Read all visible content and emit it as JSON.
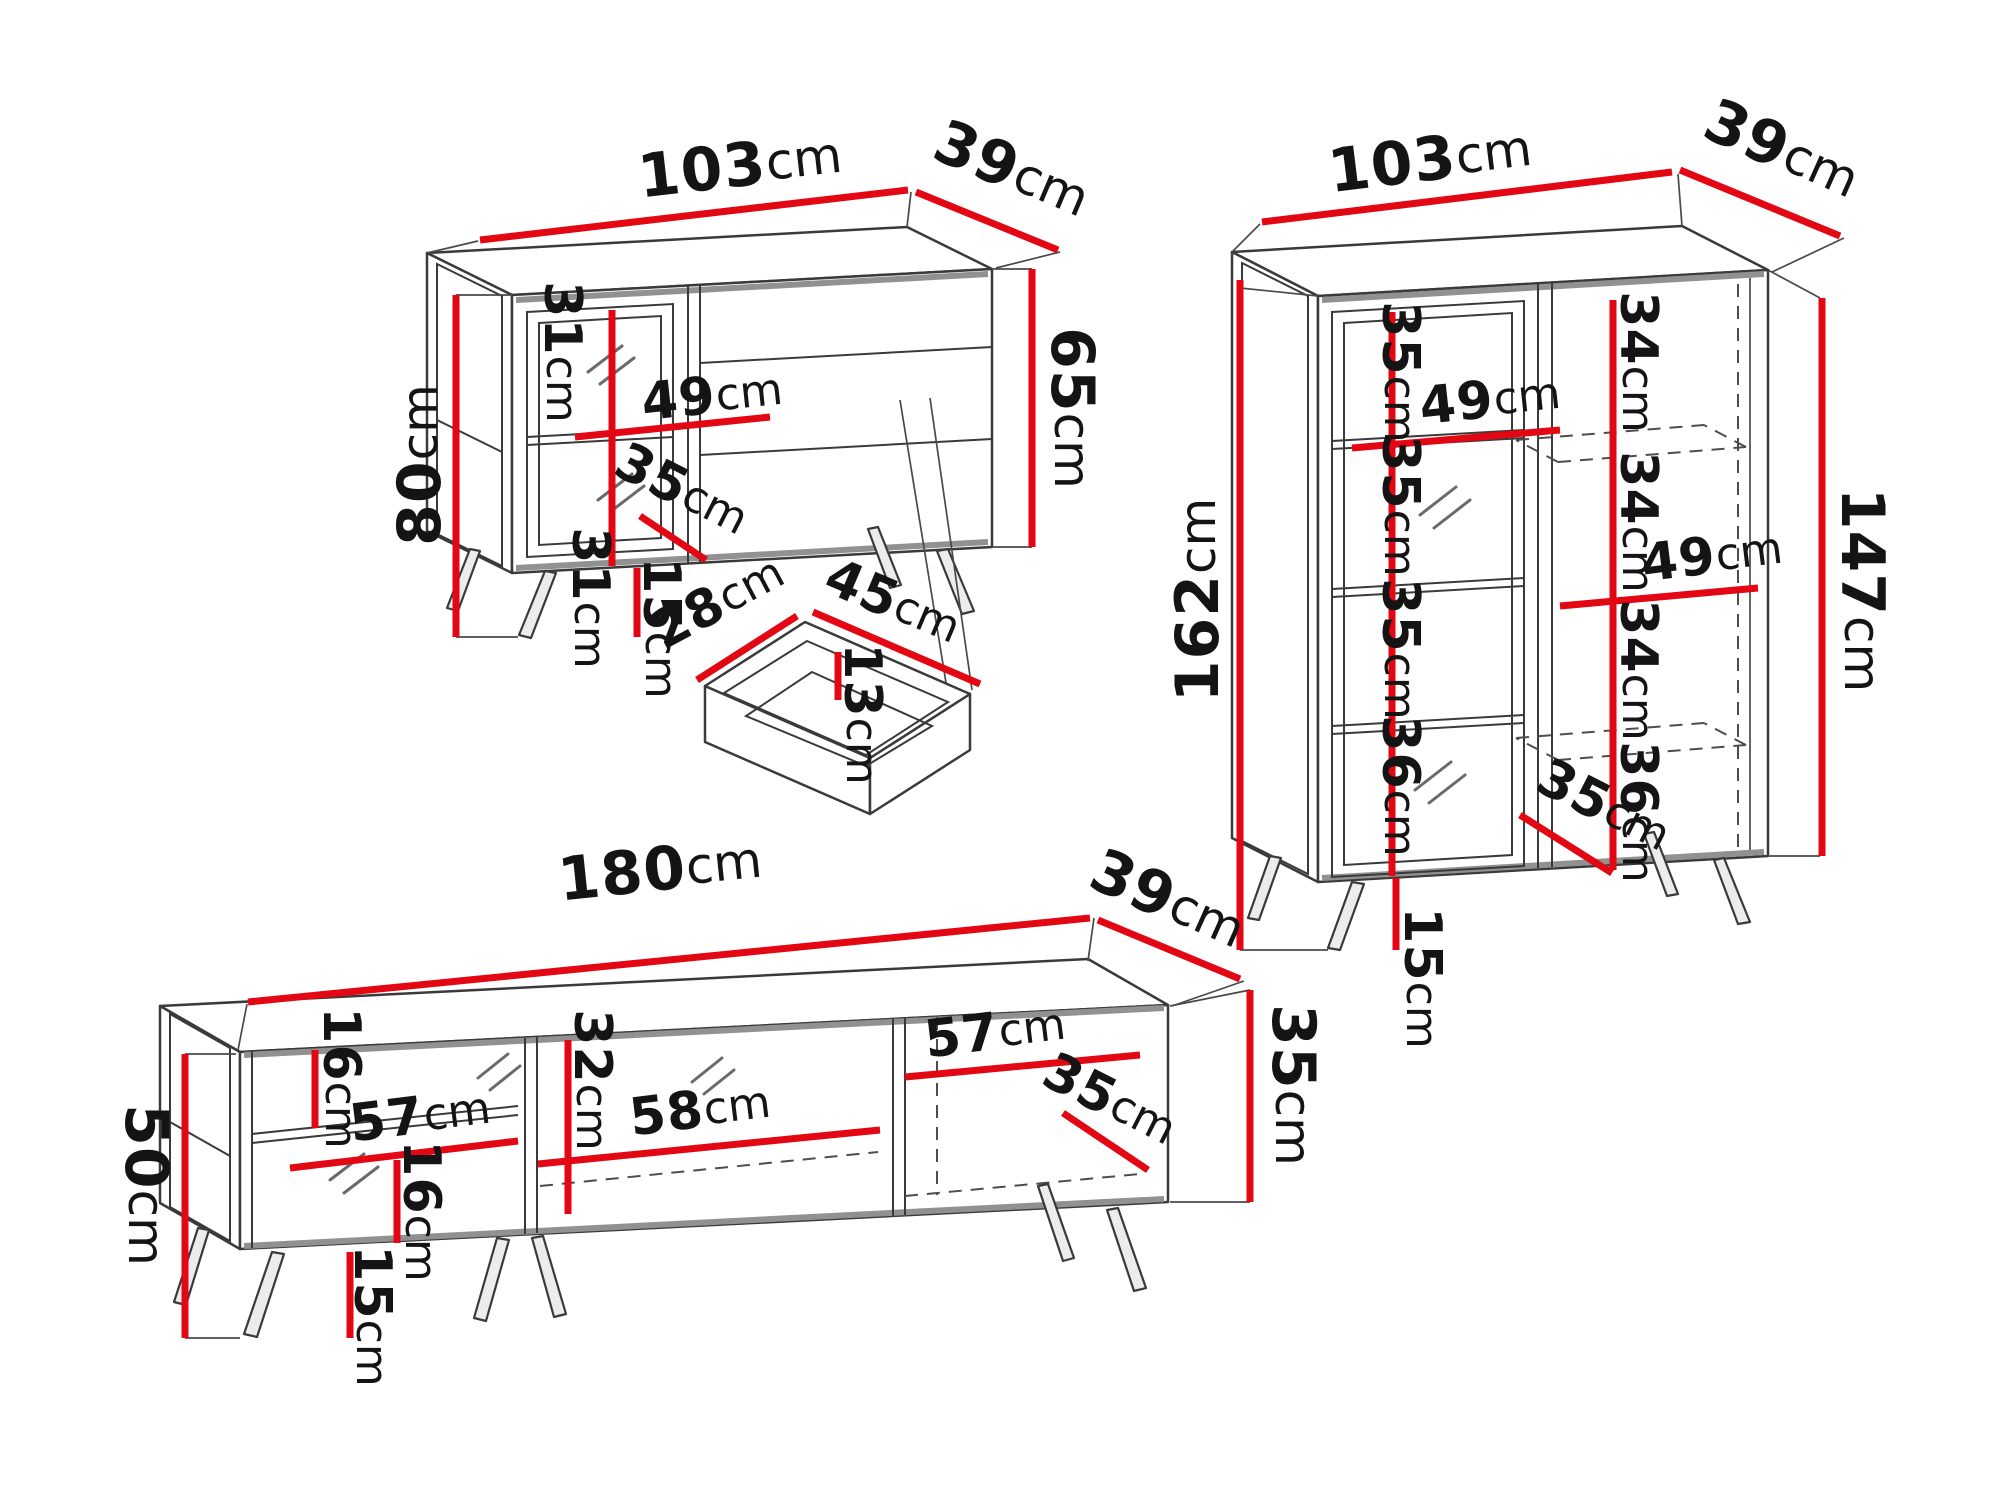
{
  "colors": {
    "dimension_red": "#e30613",
    "outline_dark": "#3a3a3a",
    "outline_gray": "#919191",
    "text": "#141414",
    "background": "#ffffff"
  },
  "sideboard": {
    "width": {
      "value": "103",
      "unit": "cm"
    },
    "depth": {
      "value": "39",
      "unit": "cm"
    },
    "height_left": {
      "value": "80",
      "unit": "cm"
    },
    "height_right": {
      "value": "65",
      "unit": "cm"
    },
    "upper_section": {
      "value": "31",
      "unit": "cm"
    },
    "shelf_width": {
      "value": "49",
      "unit": "cm"
    },
    "lower_section": {
      "value": "31",
      "unit": "cm"
    },
    "inner_depth": {
      "value": "35",
      "unit": "cm"
    },
    "leg_height": {
      "value": "15",
      "unit": "cm"
    }
  },
  "drawer_detail": {
    "width": {
      "value": "28",
      "unit": "cm"
    },
    "length": {
      "value": "45",
      "unit": "cm"
    },
    "inner_depth": {
      "value": "13",
      "unit": "cm"
    }
  },
  "display_cabinet": {
    "width": {
      "value": "103",
      "unit": "cm"
    },
    "depth": {
      "value": "39",
      "unit": "cm"
    },
    "height_left": {
      "value": "162",
      "unit": "cm"
    },
    "height_right": {
      "value": "147",
      "unit": "cm"
    },
    "left_sections": [
      {
        "value": "35",
        "unit": "cm"
      },
      {
        "value": "35",
        "unit": "cm"
      },
      {
        "value": "35",
        "unit": "cm"
      },
      {
        "value": "36",
        "unit": "cm"
      }
    ],
    "left_shelf_width": {
      "value": "49",
      "unit": "cm"
    },
    "right_sections": [
      {
        "value": "34",
        "unit": "cm"
      },
      {
        "value": "34",
        "unit": "cm"
      },
      {
        "value": "34",
        "unit": "cm"
      },
      {
        "value": "36",
        "unit": "cm"
      }
    ],
    "right_shelf_width": {
      "value": "49",
      "unit": "cm"
    },
    "inner_depth": {
      "value": "35",
      "unit": "cm"
    },
    "leg_height": {
      "value": "15",
      "unit": "cm"
    }
  },
  "tv_stand": {
    "width": {
      "value": "180",
      "unit": "cm"
    },
    "depth": {
      "value": "39",
      "unit": "cm"
    },
    "height_left": {
      "value": "50",
      "unit": "cm"
    },
    "height_right": {
      "value": "35",
      "unit": "cm"
    },
    "above_shelf": {
      "value": "16",
      "unit": "cm"
    },
    "left_shelf_width": {
      "value": "57",
      "unit": "cm"
    },
    "below_shelf": {
      "value": "16",
      "unit": "cm"
    },
    "middle_height": {
      "value": "32",
      "unit": "cm"
    },
    "middle_width": {
      "value": "58",
      "unit": "cm"
    },
    "right_width": {
      "value": "57",
      "unit": "cm"
    },
    "inner_depth": {
      "value": "35",
      "unit": "cm"
    },
    "leg_height": {
      "value": "15",
      "unit": "cm"
    }
  }
}
